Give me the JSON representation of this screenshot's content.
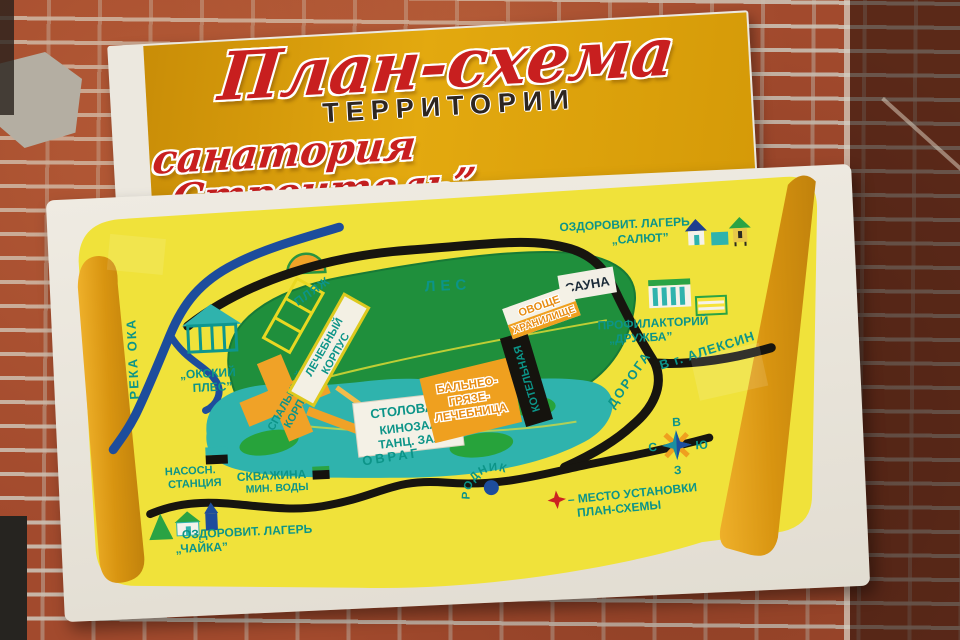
{
  "banner": {
    "title": "План-схема",
    "subtitle": "ТЕРРИТОРИИ",
    "tagline": "санатория „Строитель”"
  },
  "map": {
    "areas": {
      "reka_oka": "РЕКА ОКА",
      "plyazh": "ПЛЯЖ",
      "les": "ЛЕС",
      "ovrag": "ОВРАГ",
      "doroga": "ДОРОГА",
      "v_aleksin": "В г. АЛЕКСИН",
      "rodnik": "РОДНИК"
    },
    "places": {
      "okskiy_ples": [
        "„ОКСКИЙ",
        "ПЛЕС”"
      ],
      "nasos_stantsiya": [
        "НАСОСН.",
        "СТАНЦИЯ"
      ],
      "skvazhina": [
        "СКВАЖИНА",
        "МИН. ВОДЫ"
      ],
      "lager_salut": [
        "ОЗДОРОВИТ. ЛАГЕРЬ",
        "„САЛЮТ”"
      ],
      "profilaktoriy": [
        "ПРОФИЛАКТОРИЙ",
        "„ДРУЖБА”"
      ],
      "lager_chaika": [
        "ОЗДОРОВИТ. ЛАГЕРЬ",
        "„ЧАЙКА”"
      ]
    },
    "buildings": {
      "spalny_korpus": [
        "СПАЛЬНЫЙ",
        "КОРПУС"
      ],
      "lechebny_korpus": [
        "ЛЕЧЕБНЫЙ",
        "КОРПУС"
      ],
      "stolovaya": [
        "СТОЛОВАЯ",
        "КИНОЗАЛ",
        "ТАНЦ. ЗАЛ"
      ],
      "balneo": [
        "БАЛЬНЕО-",
        "ГРЯЗЕ-",
        "ЛЕЧЕБНИЦА"
      ],
      "kotelnaya": "КОТЕЛЬНАЯ",
      "sauna": "САУНА",
      "ovoshche": [
        "ОВОЩЕ",
        "ХРАНИЛИЩЕ"
      ]
    },
    "compass": {
      "top": "В",
      "left": "С",
      "right": "Ю",
      "bottom": "З"
    },
    "legend": {
      "line1": "– МЕСТО УСТАНОВКИ",
      "line2": "ПЛАН-СХЕМЫ"
    }
  },
  "colors": {
    "banner_gold": "#e3a90f",
    "title_red": "#c81f1f",
    "map_yellow": "#f0e23a",
    "forest_green": "#1f8f3c",
    "grounds_teal": "#2fb3ad",
    "river_blue": "#1d4d9c",
    "road_black": "#17150f",
    "building_orange": "#f0a227",
    "label_teal": "#0c9488",
    "legend_star_red": "#cc2222"
  }
}
